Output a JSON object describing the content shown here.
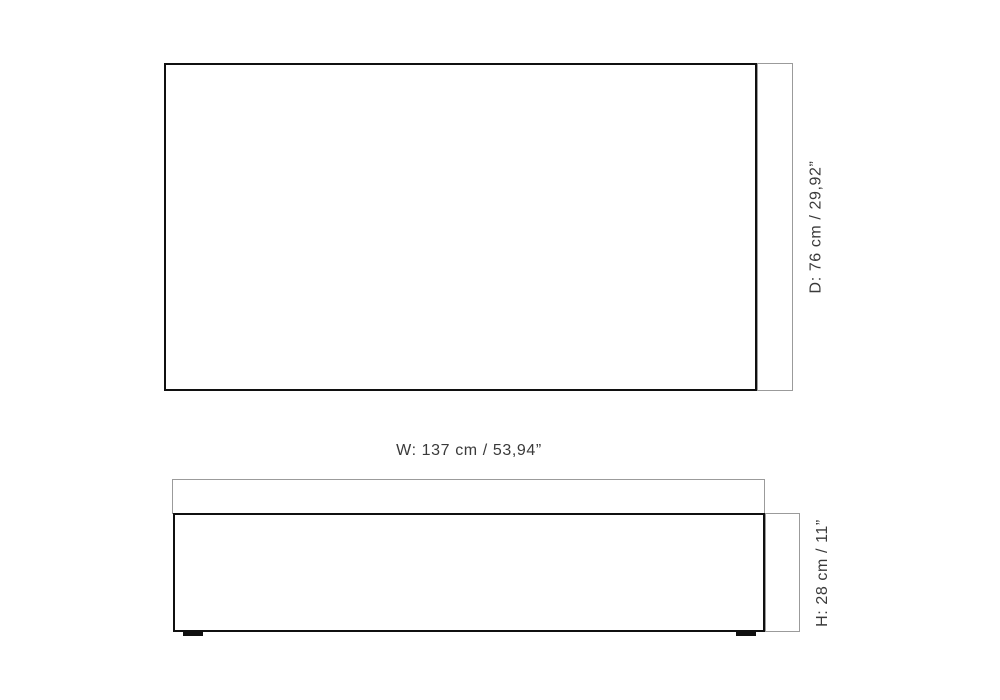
{
  "diagram": {
    "type": "furniture-dimension-drawing",
    "top_view": {
      "depth_label": "D: 76 cm / 29,92”"
    },
    "front_view": {
      "width_label": "W: 137 cm / 53,94”",
      "height_label": "H: 28 cm / 11”"
    },
    "colors": {
      "outline": "#101010",
      "bracket_line": "#9b9b9b",
      "label_text": "#3a3a3a",
      "background": "#ffffff"
    }
  }
}
